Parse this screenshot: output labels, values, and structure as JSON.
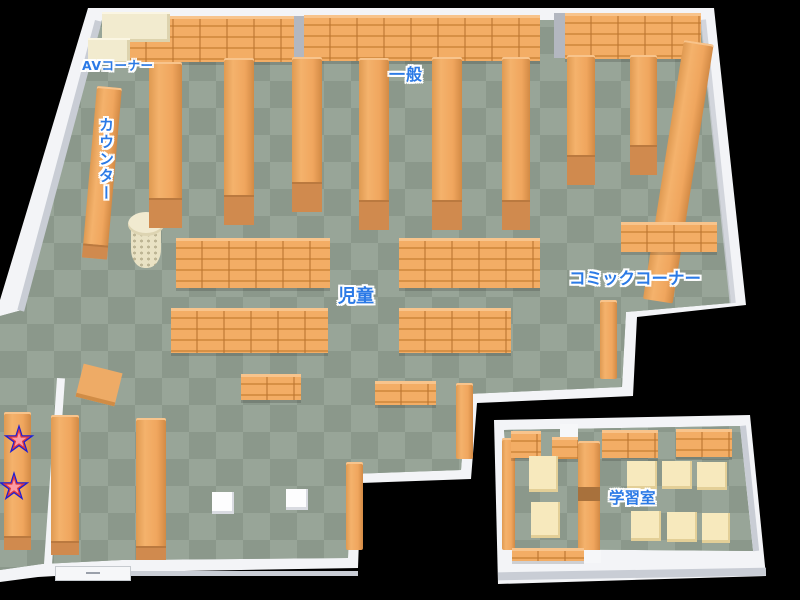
{
  "map": {
    "regions": {
      "av_corner": {
        "label": "AVコーナー"
      },
      "general": {
        "label": "一般"
      },
      "counter": {
        "label": "カウンター"
      },
      "children": {
        "label": "児童"
      },
      "comic_corner": {
        "label": "コミックコーナー"
      },
      "study_room": {
        "label": "学習室"
      }
    },
    "markers": {
      "star_count": 2
    },
    "colors": {
      "background": "#000000",
      "floor_dark": "#8b988b",
      "floor_light": "#98a598",
      "shelf_orange": "#f0a65e",
      "shelf_line": "#cf8a45",
      "wall_white": "#f3f4f7",
      "wall_shade": "#c9cdd5",
      "counter_cream": "#f2ebcf",
      "table_cream": "#f7e9bd",
      "label_blue": "#2b7ae6",
      "label_outline": "#ffffff",
      "star_pink": "#fb9aa4",
      "star_red": "#e23b3b",
      "star_outline_blue": "#1d1dd6"
    }
  }
}
